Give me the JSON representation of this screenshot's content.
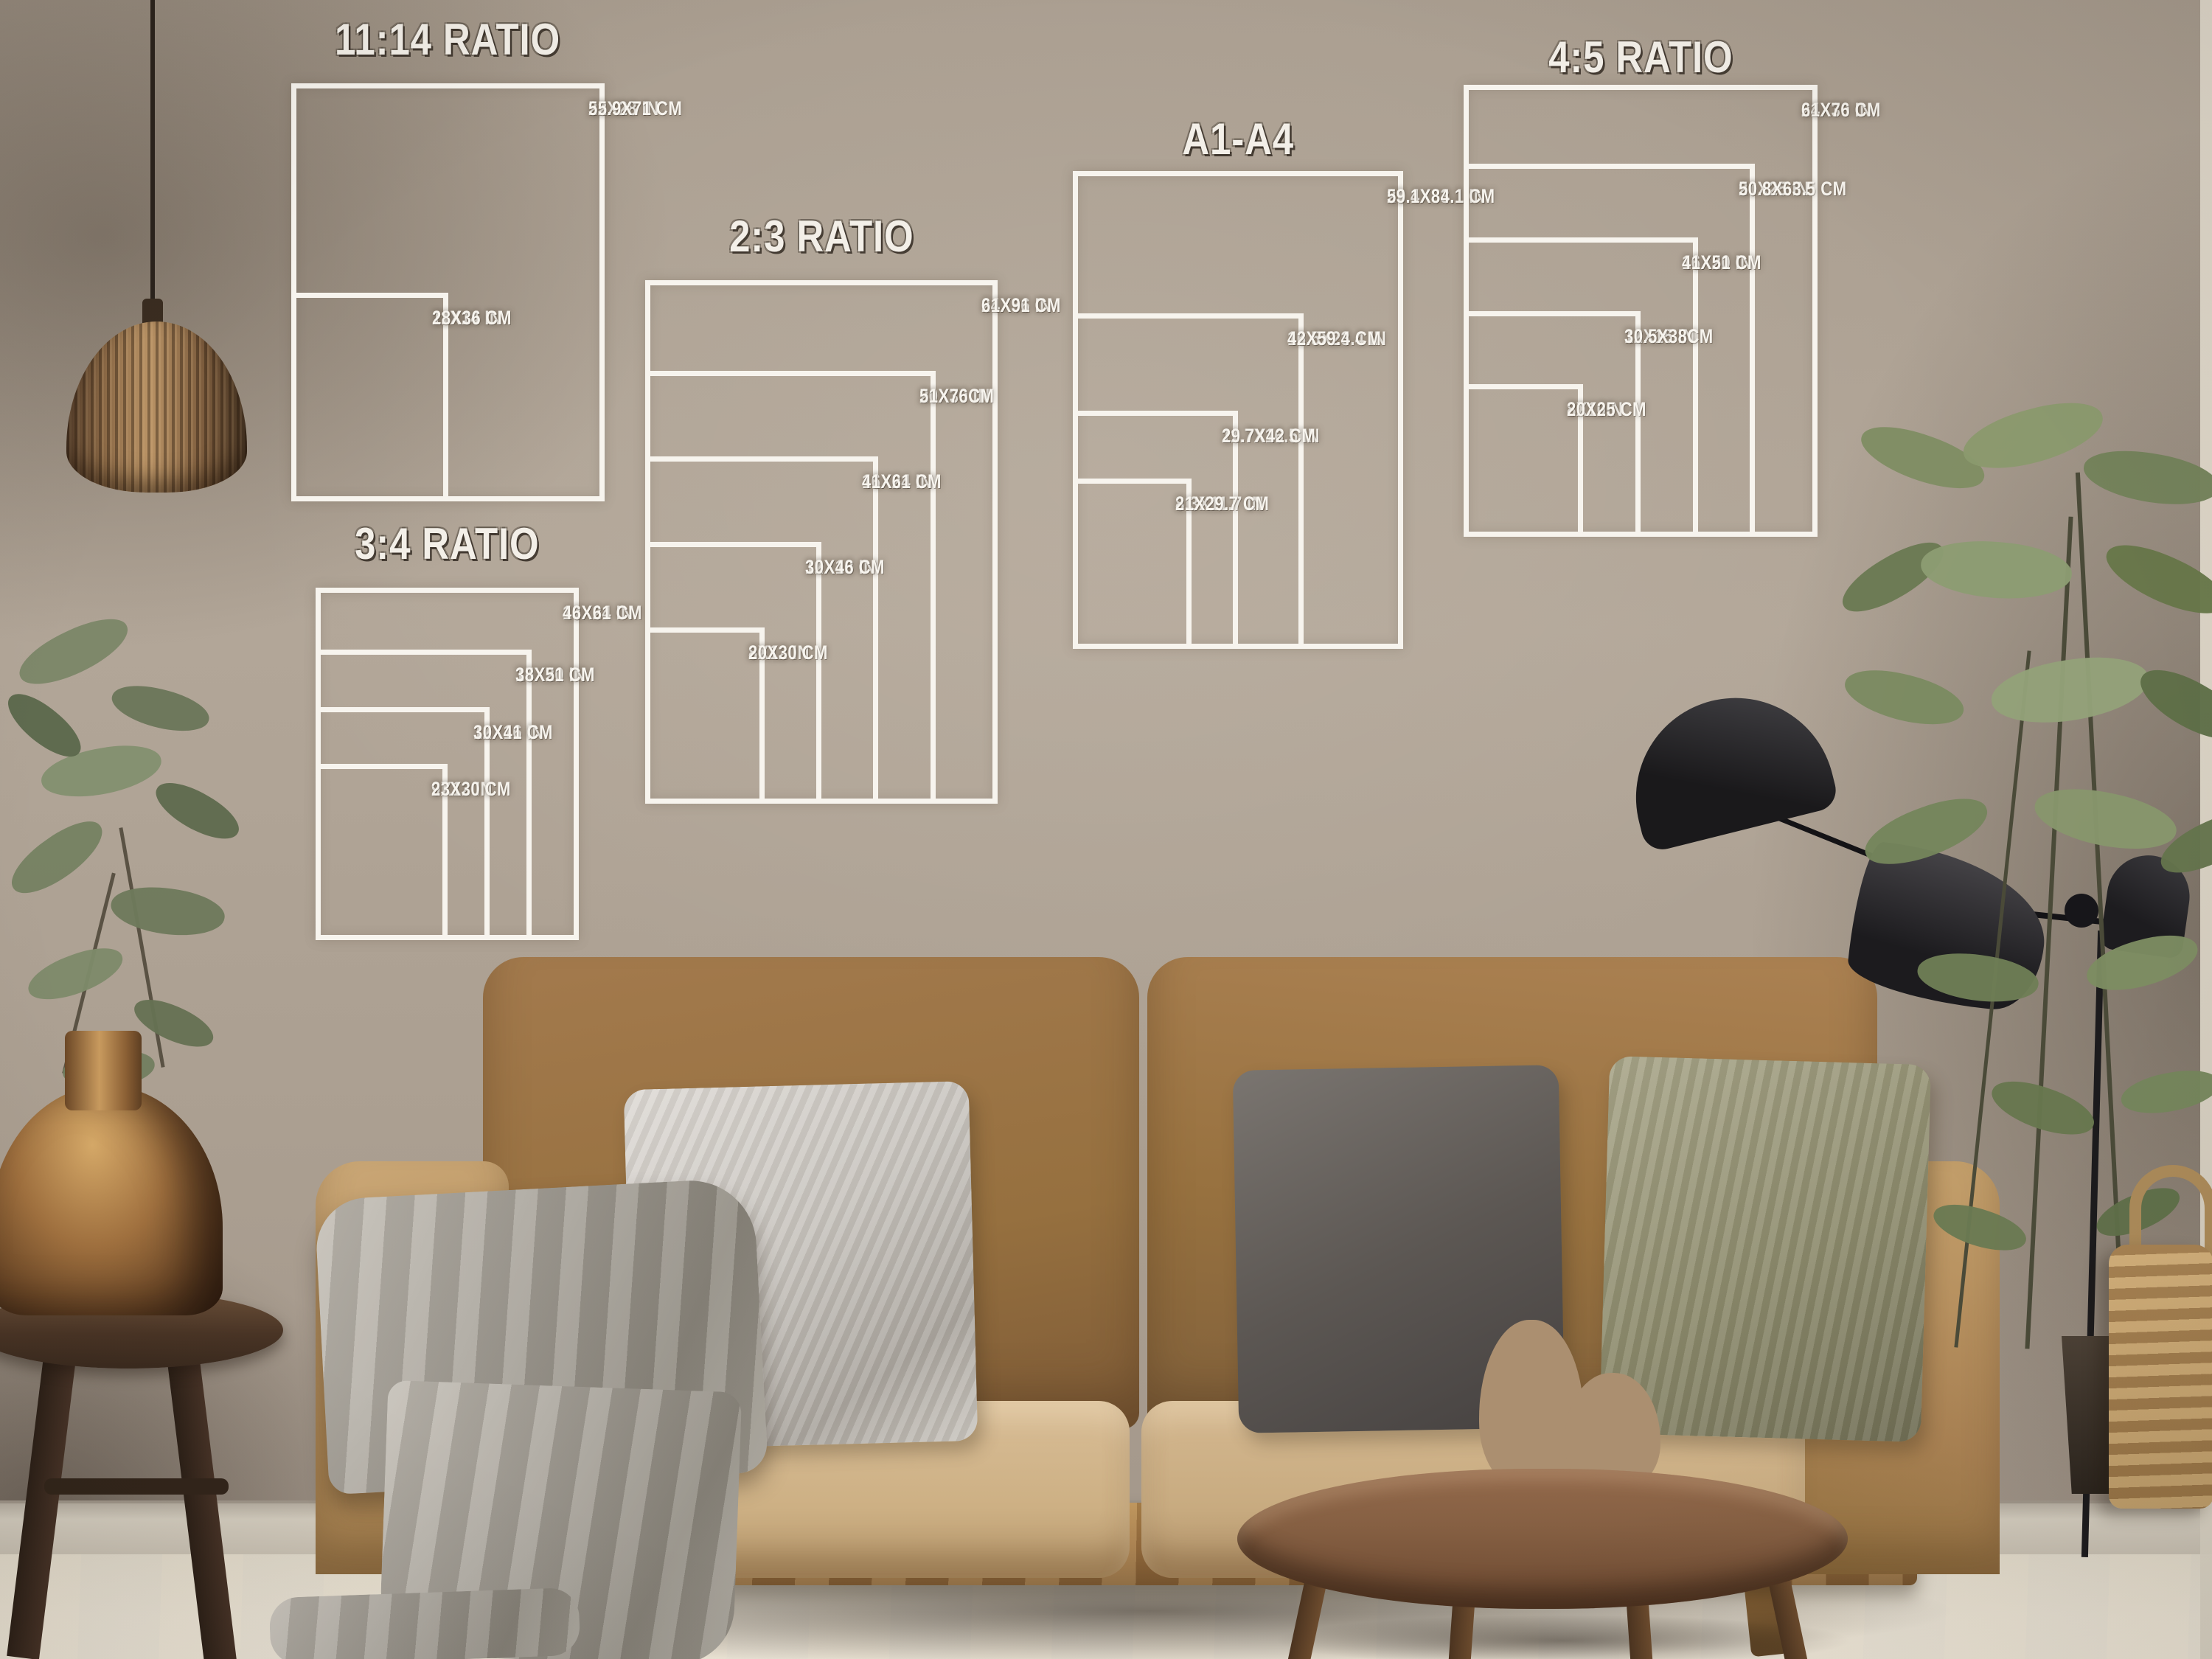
{
  "overlay": {
    "line_color": "#f7f4ee",
    "charts": [
      {
        "id": "ratio-11-14",
        "title": "11:14 RATIO",
        "sizes": [
          {
            "inches": "22X28 IN",
            "cm": "55.9X71 CM",
            "w": 22,
            "h": 28
          },
          {
            "inches": "11X14 IN",
            "cm": "28X36 CM",
            "w": 11,
            "h": 14
          }
        ]
      },
      {
        "id": "ratio-3-4",
        "title": "3:4 RATIO",
        "sizes": [
          {
            "inches": "18X24 IN",
            "cm": "46X61 CM",
            "w": 18,
            "h": 24
          },
          {
            "inches": "15X20 IN",
            "cm": "38X51 CM",
            "w": 15,
            "h": 20
          },
          {
            "inches": "12X16 IN",
            "cm": "30X41 CM",
            "w": 12,
            "h": 16
          },
          {
            "inches": "9X12 IN",
            "cm": "23X30 CM",
            "w": 9,
            "h": 12
          }
        ]
      },
      {
        "id": "ratio-2-3",
        "title": "2:3 RATIO",
        "sizes": [
          {
            "inches": "24X36 IN",
            "cm": "61X91 CM",
            "w": 24,
            "h": 36
          },
          {
            "inches": "20X30 IN",
            "cm": "51X76CM",
            "w": 20,
            "h": 30
          },
          {
            "inches": "16X24 IN",
            "cm": "41X61 CM",
            "w": 16,
            "h": 24
          },
          {
            "inches": "12X18 IN",
            "cm": "30X46 CM",
            "w": 12,
            "h": 18
          },
          {
            "inches": "8X12 IN",
            "cm": "20X30 CM",
            "w": 8,
            "h": 12
          }
        ]
      },
      {
        "id": "a1-a4",
        "title": "A1-A4",
        "sizes": [
          {
            "inches": "23.4X33.1 IN",
            "cm": "59.1X84.1 CM",
            "w": 23.4,
            "h": 33.1
          },
          {
            "inches": "16.5X23.4 IN",
            "cm": "42X59.4 CM",
            "w": 16.5,
            "h": 23.4
          },
          {
            "inches": "11.7X16.5 IN",
            "cm": "29.7X42 CM",
            "w": 11.7,
            "h": 16.5
          },
          {
            "inches": "8.3X11.7 IN",
            "cm": "21X29.7 CM",
            "w": 8.3,
            "h": 11.7
          }
        ]
      },
      {
        "id": "ratio-4-5",
        "title": "4:5 RATIO",
        "sizes": [
          {
            "inches": "24X30 IN",
            "cm": "61X76 CM",
            "w": 24,
            "h": 30
          },
          {
            "inches": "20X25 IN",
            "cm": "50.8X63.5 CM",
            "w": 20,
            "h": 25
          },
          {
            "inches": "16X20 IN",
            "cm": "41X51 CM",
            "w": 16,
            "h": 20
          },
          {
            "inches": "12X15 IN",
            "cm": "30.5X38CM",
            "w": 12,
            "h": 15
          },
          {
            "inches": "8X10IN",
            "cm": "20X25 CM",
            "w": 8,
            "h": 10
          }
        ]
      }
    ]
  },
  "palette": {
    "wall": "#b0a496",
    "wall_shadow": "#8a8072",
    "baseboard": "#cfc8ba",
    "floor": "#e9e3d6",
    "sofa": "#a87e50",
    "seat": "#d3b78e",
    "pillow_silver": "#c7c3bd",
    "pillow_graphite": "#55504c",
    "pillow_sage": "#95936f",
    "blanket": "#a39e95",
    "wood": "#7d5a3c",
    "copper": "#a1713f",
    "lamp_black": "#1c1b1d",
    "plant_green": "#7b8a61",
    "basket": "#c09a66",
    "overlay_line": "#f7f4ee"
  }
}
